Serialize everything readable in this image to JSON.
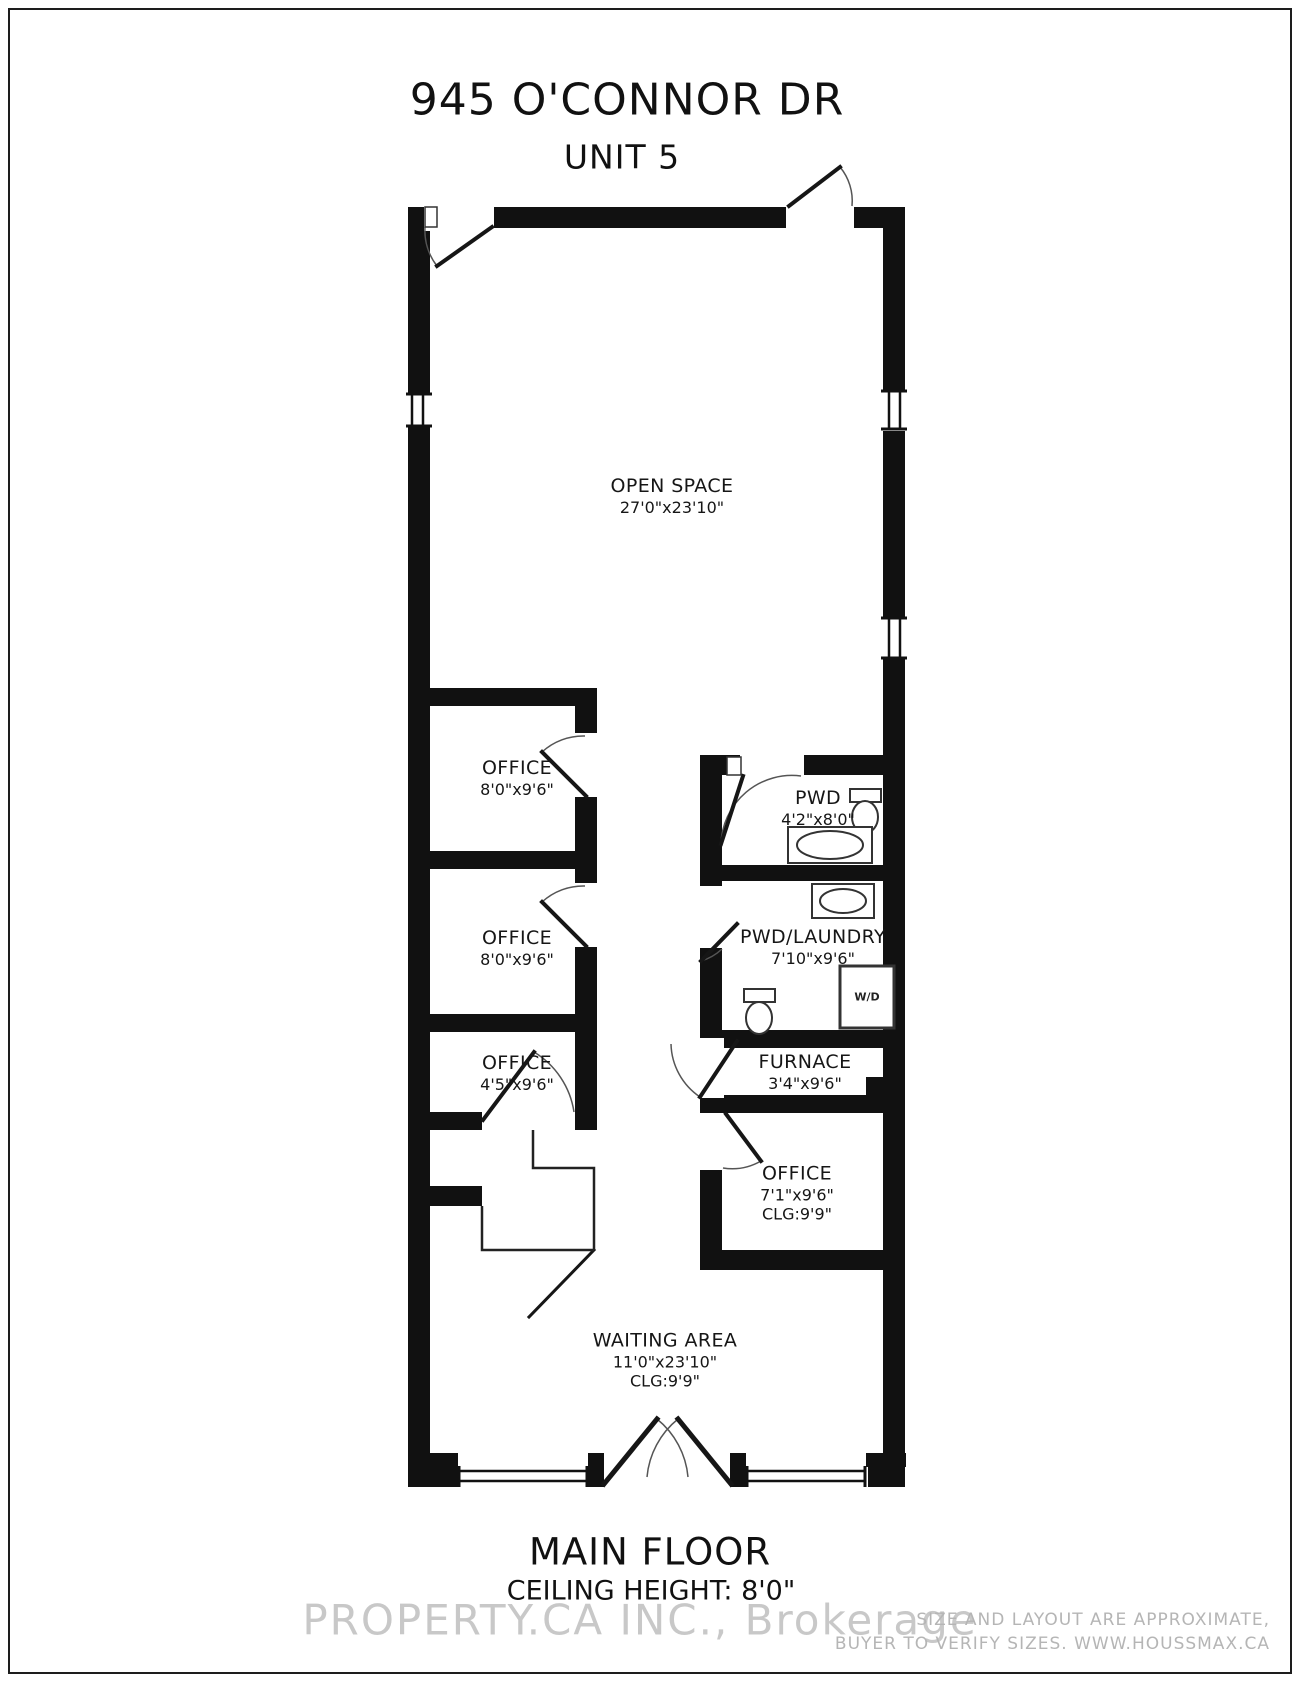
{
  "title": {
    "line1": "945 O'CONNOR DR",
    "line2": "UNIT 5"
  },
  "rooms": {
    "open_space": {
      "name": "OPEN SPACE",
      "dims": "27'0\"x23'10\""
    },
    "office1": {
      "name": "OFFICE",
      "dims": "8'0\"x9'6\""
    },
    "office2": {
      "name": "OFFICE",
      "dims": "8'0\"x9'6\""
    },
    "office3": {
      "name": "OFFICE",
      "dims": "4'5\"x9'6\""
    },
    "pwd": {
      "name": "PWD",
      "dims": "4'2\"x8'0\""
    },
    "pwd_laundry": {
      "name": "PWD/LAUNDRY",
      "dims": "7'10\"x9'6\""
    },
    "furnace": {
      "name": "FURNACE",
      "dims": "3'4\"x9'6\""
    },
    "office4": {
      "name": "OFFICE",
      "dims": "7'1\"x9'6\"",
      "clg": "CLG:9'9\""
    },
    "waiting": {
      "name": "WAITING AREA",
      "dims": "11'0\"x23'10\"",
      "clg": "CLG:9'9\""
    }
  },
  "labels": {
    "wd": "W/D"
  },
  "footer": {
    "floor": "MAIN FLOOR",
    "ceiling": "CEILING HEIGHT: 8'0\""
  },
  "watermark": "PROPERTY.CA INC., Brokerage",
  "disclaimer": {
    "line1": "SIZE AND LAYOUT ARE APPROXIMATE,",
    "line2": "BUYER TO VERIFY SIZES. WWW.HOUSSMAX.CA"
  },
  "colors": {
    "wall": "#111111",
    "watermark": "#bebebe",
    "disclaimer": "#b5b5b5"
  }
}
